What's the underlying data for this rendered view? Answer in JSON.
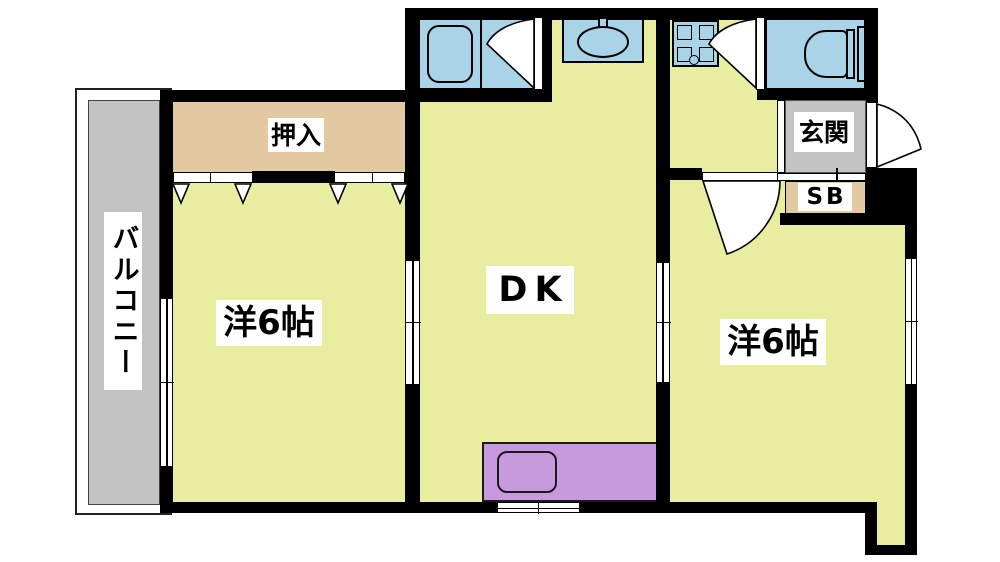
{
  "floorplan": {
    "description": "Japanese 2DK apartment floor plan",
    "rooms": {
      "balcony": {
        "label": "バルコニー"
      },
      "closet": {
        "label": "押入"
      },
      "western_room_left": {
        "label": "洋6帖",
        "size_tatami": 6
      },
      "dining_kitchen": {
        "label": "DK"
      },
      "western_room_right": {
        "label": "洋6帖",
        "size_tatami": 6
      },
      "entrance": {
        "label": "玄関"
      },
      "shoe_box": {
        "label": "SB"
      }
    },
    "fixture_icons": [
      "bathtub-icon",
      "bath-door-swing-icon",
      "washbasin-icon",
      "washing-machine-pan-icon",
      "toilet-icon",
      "toilet-door-swing-icon",
      "entrance-door-swing-icon",
      "room-door-swing-icon",
      "kitchen-counter-icon",
      "kitchen-sink-icon",
      "sliding-window-icon",
      "closet-sliding-door-icon"
    ],
    "colors": {
      "room_floor": "#e9ed9f",
      "closet_fill": "#e2c9a2",
      "water_fixture": "#a9d3e6",
      "kitchen_counter": "#c79ade",
      "concrete_gray": "#c3c3c3",
      "wall": "#000000",
      "background": "#ffffff"
    }
  }
}
